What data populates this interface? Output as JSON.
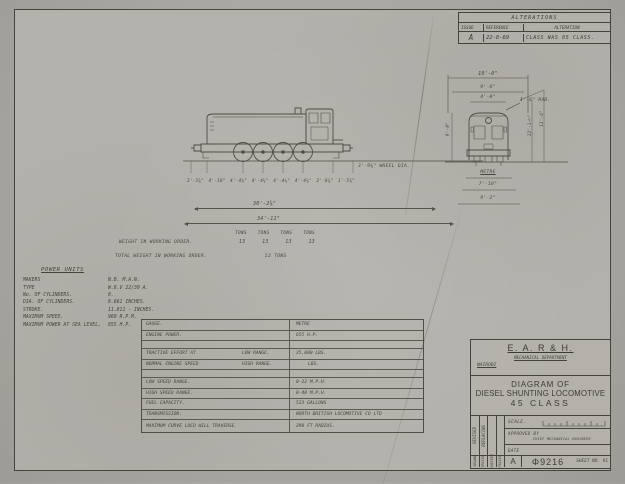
{
  "alterations": {
    "title": "ALTERATIONS",
    "headers": [
      "ISSUE",
      "REFERENCE",
      "ALTERATION"
    ],
    "entry": {
      "issue": "A",
      "reference": "22-8-69",
      "alteration": "CLASS WAS 85 CLASS."
    }
  },
  "side_view": {
    "wheel_dia": "3'-9⅝\" WHEEL DIA.",
    "axle_dims": [
      "2'-3⅞\"",
      "4'-10\"",
      "4'-4¼\"",
      "4'-4¼\"",
      "4'-4¼\"",
      "4'-4¼\"",
      "2'-0⅞\"",
      "1'-5⅝\""
    ],
    "overall_length_1": "30'-2⅝\"",
    "overall_length_2": "34'-11\"",
    "tons": [
      "TONS",
      "TONS",
      "TONS",
      "TONS"
    ],
    "weight_label": "WEIGHT IN WORKING ORDER.",
    "axle_weights": [
      "13",
      "13",
      "13",
      "13"
    ],
    "total_weight_label": "TOTAL WEIGHT IN WORKING ORDER.",
    "total_weight_value": "52 TONS"
  },
  "end_view": {
    "width_overall": "10'-0\"",
    "width_body": "9'-6\"",
    "width_top": "4'-0\"",
    "roof_radius": "1'-6\" RAD.",
    "height_left": "9'-0\"",
    "height_inner": "12'-1½\"",
    "height_outer": "13'-6\"",
    "gauge": "METRE",
    "width_bottom_1": "7'-10\"",
    "width_bottom_2": "9'-2\""
  },
  "power_units": {
    "title": "POWER UNITS",
    "rows": [
      {
        "label": "MAKERS",
        "value": "N.B.  M.A.N."
      },
      {
        "label": "TYPE",
        "value": "W.8.V 22/30 A."
      },
      {
        "label": "No. OF CYLINDERS.",
        "value": "8."
      },
      {
        "label": "DIA. OF CYLINDERS.",
        "value": "8.661 INCHES."
      },
      {
        "label": "STROKE.",
        "value": "11.811 - INCHES."
      },
      {
        "label": "MAXIMUM SPEED.",
        "value": "960  R.P.M."
      },
      {
        "label": "MAXIMUM POWER AT SEA LEVEL,",
        "value": "855 H.P."
      }
    ]
  },
  "spec": {
    "rows": [
      {
        "label": "GAUGE.",
        "sub": "",
        "value": "METRE"
      },
      {
        "label": "ENGINE POWER.",
        "sub": "",
        "value": "655   H.P."
      },
      {
        "label": "",
        "sub": "",
        "value": ""
      },
      {
        "label": "TRACTIVE EFFORT AT",
        "sub": "LOW RANGE.",
        "value": "35,000  LBS."
      },
      {
        "label": "NORMAL ENGINE SPEED",
        "sub": "HIGH RANGE.",
        "value": "LBS."
      },
      {
        "label": "",
        "sub": "",
        "value": ""
      },
      {
        "label": "LOW SPEED RANGE.",
        "sub": "",
        "value": "0-22    M.P.H."
      },
      {
        "label": "HIGH SPEED RANGE.",
        "sub": "",
        "value": "0-40    M.P.H."
      },
      {
        "label": "FUEL CAPACITY.",
        "sub": "",
        "value": "523    GALLONS"
      },
      {
        "label": "TRANSMISSION.",
        "sub": "",
        "value": "NORTH BRITISH LOCOMOTIVE CO LTD"
      },
      {
        "label": "MAXIMUM CURVE LOCO WILL TRAVERSE.",
        "sub": "",
        "value": "290  FT RADIUS."
      }
    ]
  },
  "title_block": {
    "org": "E. A. R & H.",
    "department": "MECHANICAL DEPARTMENT",
    "location": "NAIROBI",
    "title_line_1": "DIAGRAM OF",
    "title_line_2": "DIESEL SHUNTING LOCOMOTIVE",
    "title_line_3": "45 CLASS",
    "scale_label": "SCALE.",
    "approved_label": "APPROVED BY",
    "approver": "CHIEF MECHANICAL ENGINEER",
    "date_label": "DATE",
    "issue": "A",
    "drawing_number": "Φ9216",
    "sheet_number": "SHEET NO. 91",
    "side_labels": [
      "REVISED",
      "REPLACING"
    ],
    "bottom_labels": [
      "DRAWN",
      "TRACED",
      "CHECKED",
      "PASSED"
    ]
  }
}
